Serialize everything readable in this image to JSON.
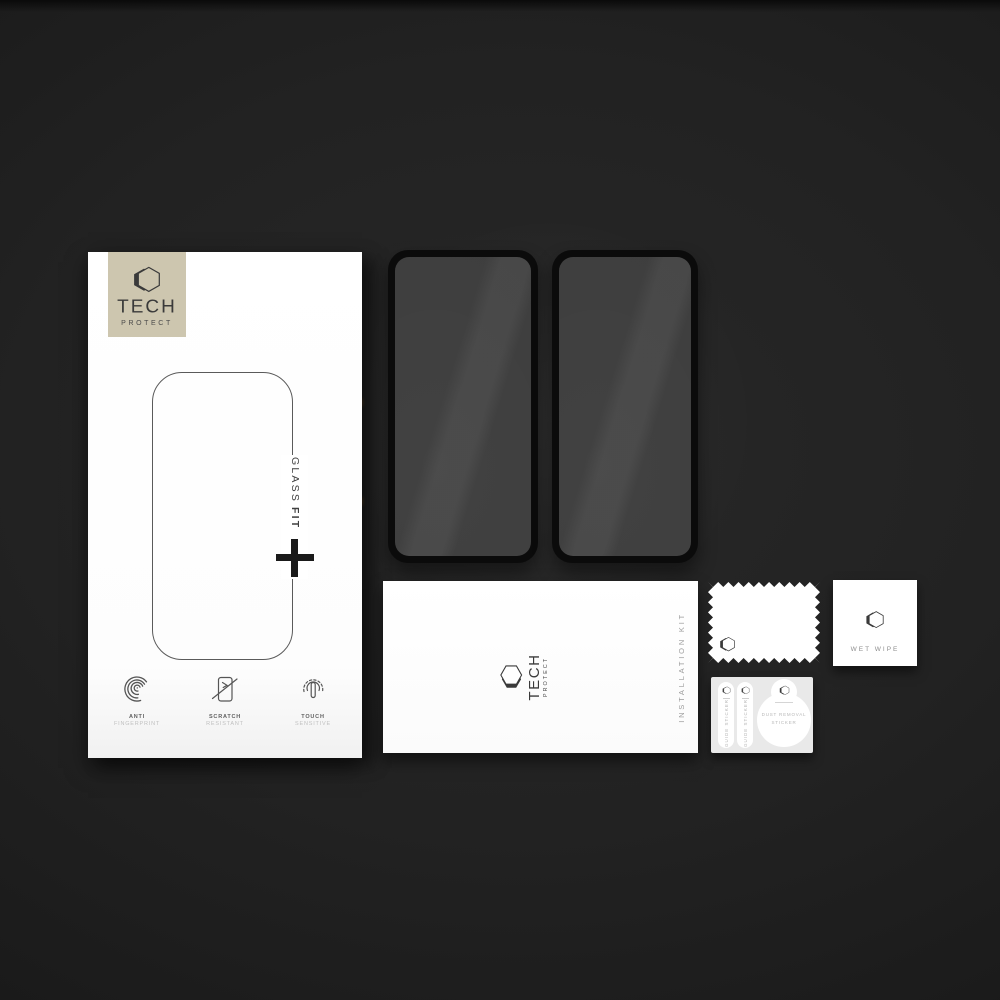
{
  "product": {
    "brand": {
      "line1": "TECH",
      "line2": "PROTECT"
    },
    "retail_box": {
      "glass_fit_word1": "GLASS",
      "glass_fit_word2": "FIT",
      "features": [
        {
          "icon": "fingerprint-icon",
          "line1": "ANTI",
          "line2": "FINGERPRINT"
        },
        {
          "icon": "scratch-icon",
          "line1": "SCRATCH",
          "line2": "RESISTANT"
        },
        {
          "icon": "touch-icon",
          "line1": "TOUCH",
          "line2": "SENSITIVE"
        }
      ]
    },
    "installation_kit": {
      "label": "INSTALLATION KIT"
    },
    "wet_wipe": {
      "label": "WET WIPE"
    },
    "sticker_sheet": {
      "guide_sticker_label": "GUIDE STICKER",
      "dust_sticker_line1": "DUST REMOVAL",
      "dust_sticker_line2": "STICKER"
    },
    "colors": {
      "brand_badge": "#cdc6af",
      "background": "#1e1e1e",
      "glass": "#3e3e3e"
    }
  }
}
